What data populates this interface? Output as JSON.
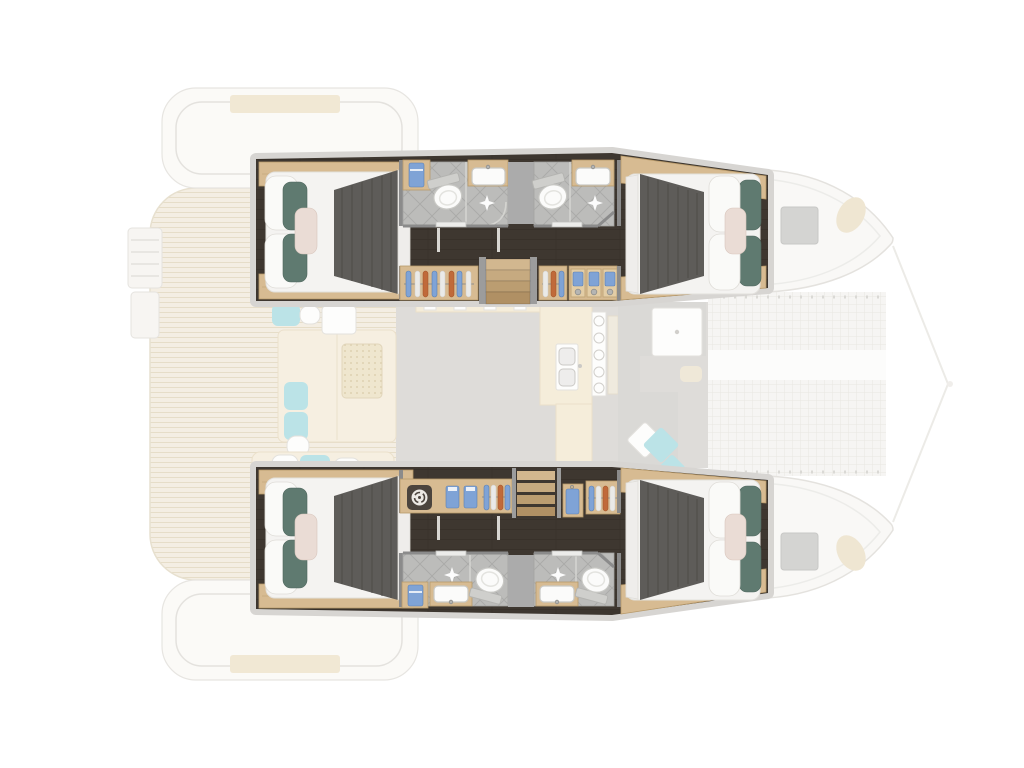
{
  "meta": {
    "title": "Catamaran four-cabin deck plan",
    "view": "top-down yacht layout diagram, bow to the right",
    "rendering": "lower-deck cabins highlighted in full color, main deck ghosted in pale tones"
  },
  "colors": {
    "wall": "#8b8b8b",
    "wall_light": "#d7d5d2",
    "floor_dark": "#3e3730",
    "wood": "#d7bb92",
    "wood_edge": "#b89a6a",
    "tile": "#bcbcba",
    "tile_line": "#a7a7a5",
    "divider": "#ababab",
    "duvet": "#f4f3f1",
    "runner": "#5e5c59",
    "runner_streak": "#4c4a47",
    "pillow_teal": "#5f7a70",
    "pillow_pink": "#eadcd5",
    "pillow_white": "#fafaf8",
    "fixture_white": "#fbfbfa",
    "fixture_stroke": "#c9c9c5",
    "cloth_blue": "#7fa3d6",
    "cloth_orange": "#c06a3a",
    "cloth_white": "#eaeae8",
    "knob": "#b5b5b3",
    "washer_dark": "#4b443e",
    "step_a": "#d2b78f",
    "step_b": "#c6aa80",
    "step_c": "#bb9d71",
    "step_d": "#b09064",
    "ghost_cream": "#f5edd9",
    "ghost_outline": "#e3e1dd",
    "ghost_teal": "#b8e2e6",
    "background": "#ffffff"
  },
  "plan": {
    "highlight": "four guest cabins with en-suite bathrooms, one in each end of both hulls",
    "upper_hull": {
      "rooms": [
        "aft double cabin",
        "en-suite bathroom",
        "technical locker",
        "en-suite bathroom",
        "corridor",
        "hanging wardrobe",
        "companionway staircase",
        "drawer unit",
        "forward double cabin"
      ]
    },
    "lower_hull": {
      "rooms": [
        "aft double cabin",
        "laundry with washing machine",
        "folded linen shelf",
        "hanging wardrobe",
        "companionway shelf staircase",
        "hanging locker",
        "corridor",
        "en-suite bathroom",
        "technical locker",
        "en-suite bathroom",
        "forward double cabin"
      ]
    },
    "ghosted_deck": [
      "swim ladder",
      "teak aft deck",
      "coachroof panels",
      "aft cockpit sofas with cushions",
      "wicker coffee table",
      "saloon galley with double sink and stove",
      "forward cockpit sofa and table",
      "scatter cushions",
      "deck hatches",
      "bow trampoline with cross beam",
      "bow bridle lines"
    ],
    "fixtures": {
      "double_beds": 4,
      "toilets": 4,
      "washbasins": 4,
      "showers": 4,
      "staircases": 2,
      "washing_machines": 1
    }
  }
}
